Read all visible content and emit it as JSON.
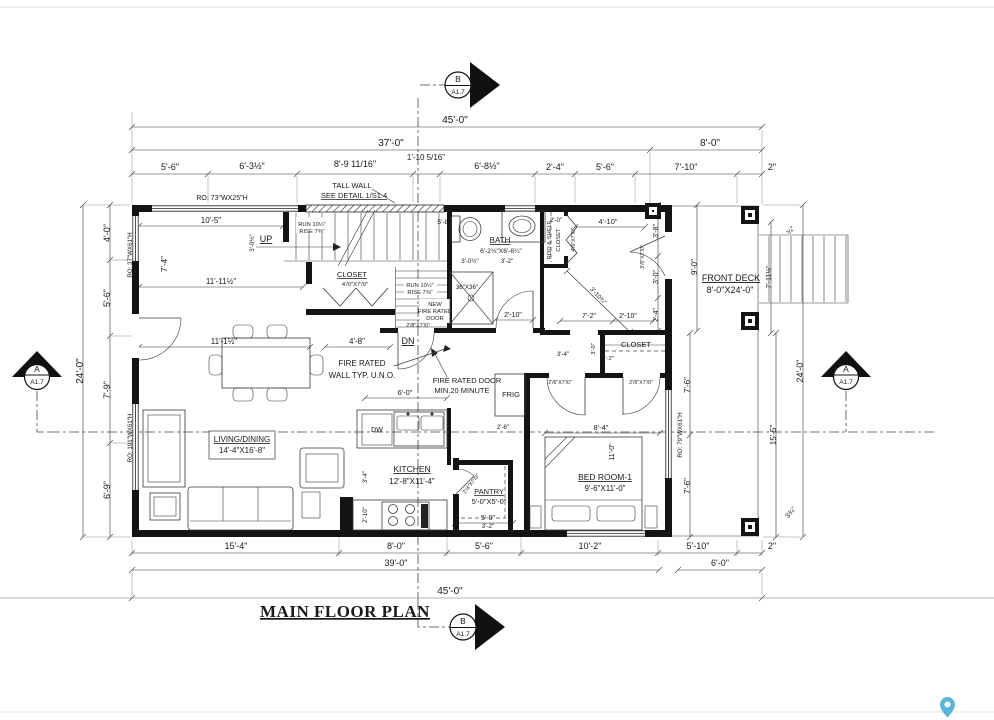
{
  "title": "MAIN FLOOR PLAN",
  "markers": {
    "top": {
      "letter": "B",
      "sheet": "A1.7"
    },
    "bottom": {
      "letter": "B",
      "sheet": "A1.7"
    },
    "left": {
      "letter": "A",
      "sheet": "A1.7"
    },
    "right": {
      "letter": "A",
      "sheet": "A1.7"
    }
  },
  "labels": {
    "dim_top_45": "45'-0\"",
    "dim_top_37": "37'-0\"",
    "dim_top_8": "8'-0\"",
    "dim_top_5_6": "5'-6\"",
    "dim_top_6_3": "6'-3½\"",
    "dim_top_8_9": "8'-9 11/16\"",
    "dim_top_1_10": "1'-10 5/16\"",
    "dim_top_6_8": "6'-8½\"",
    "dim_top_2_4": "2'-4\"",
    "dim_top_5_6b": "5'-6\"",
    "dim_top_7_10": "7'-10\"",
    "dim_top_2": "2\"",
    "dim_left_24": "24'-0\"",
    "dim_left_4_0": "4'-0\"",
    "dim_left_5_6": "5'-6\"",
    "dim_left_7_9": "7'-9\"",
    "dim_left_6_9": "6'-9\"",
    "dim_bot_15_4": "15'-4\"",
    "dim_bot_8_0": "8'-0\"",
    "dim_bot_5_6": "5'-6\"",
    "dim_bot_10_2": "10'-2\"",
    "dim_bot_5_10": "5'-10\"",
    "dim_bot_2": "2\"",
    "dim_bot_39": "39'-0\"",
    "dim_bot_6_0": "6'-0\"",
    "dim_bot_45": "45'-0\"",
    "dim_right_3_8": "3'-8\"",
    "dim_right_3_0": "3'-0\"",
    "dim_right_2_4": "2'-4\"",
    "dim_right_9_0": "9'-0\"",
    "dim_right_7_6a": "7'-6\"",
    "dim_right_7_6b": "7'-6\"",
    "dim_right_24": "24'-0\"",
    "dim_right_15_5": "15'-5\"",
    "dim_right_7_11": "7'-11½\"",
    "dim_right_034": "¾\"",
    "dim_right_334": "3¾\"",
    "ro_top": "RO: 73\"WX25\"H",
    "ro_left_upper": "RO: 37\"WX61\"H",
    "ro_left_lower": "RO: 191\"WX61\"H",
    "ro_right": "RO: 79\"WX61\"H",
    "tall_wall_1": "TALL WALL",
    "tall_wall_2": "SEE DETAIL 1/S1.4",
    "dim_10_5": "10'-5\"",
    "up": "UP",
    "run1": "RUN 10½\"",
    "rise1": "RISE 7⅜\"",
    "dim_11_11": "11'-11½\"",
    "dim_7_4": "7'-4\"",
    "dim_3_0h": "3'-0½\"",
    "stair_closet": "CLOSET",
    "stair_closet_door": "4'/0\"X7'/0\"",
    "dim_5_8": "5'-8\"",
    "run2": "RUN 10½\"",
    "rise2": "RISE 7⅜\"",
    "new_fr_1": "NEW",
    "new_fr_2": "FIRE RATED",
    "new_fr_3": "DOOR",
    "fr_door_size": "2'/8\"X7'/0\"",
    "dn": "DN",
    "dim_4_8": "4'-8\"",
    "dim_11_1": "11'-1½\"",
    "bath": "BATH",
    "bath_dims": "6'-2½\"X6'-6¼\"",
    "dim_3_0b": "3'-0½\"",
    "dim_3_2b": "3'-2\"",
    "shower": "36\"X36\"",
    "dim_2_10b": "2'-10\"",
    "dim_2_0": "2'-0\"",
    "rod_shelf": "ROD & SHELF",
    "entry_closet": "CLOSET",
    "entry_closet_door": "4'/0\"X7'/0\"",
    "dim_4_10": "4'-10\"",
    "dim_3_10": "3'-10¾\"",
    "dim_7_2": "7'-2\"",
    "dim_2_10e": "2'-10\"",
    "front_door_size": "3'/0\"X7'/0\"",
    "bed_closet": "CLOSET",
    "dim_3_4c": "3'-4\"",
    "dim_3_0c": "3'-0\"",
    "dim_1_2": "1'-2\"",
    "bed_door_size": "2'/6\"X7'/0\"",
    "closet_door_size": "2'/6\"X7'/0\"",
    "dim_8_4": "8'-4\"",
    "dim_11_0": "11'-0\"",
    "bedroom": "BED ROOM-1",
    "bedroom_dims": "9'-6\"X11'-0\"",
    "fire_wall_1": "FIRE RATED",
    "fire_wall_2": "WALL TYP. U.N.O.",
    "fire_door_1": "FIRE RATED DOOR",
    "fire_door_2": "MIN.20 MINUTE",
    "frig": "FRIG",
    "living": "LIVING/DINING",
    "living_dims": "14'-4\"X16'-8\"",
    "kitchen": "KITCHEN",
    "kitchen_dims": "12'-8\"X11'-4\"",
    "dw": "DW",
    "pantry": "PANTRY",
    "pantry_dims": "5'-0\"X5'-0\"",
    "dim_5_0": "5'-0\"",
    "dim_3_2p": "3'-2\"",
    "pantry_door_size": "2'/4\"X7'/0\"",
    "dim_3_4k": "3'-4\"",
    "dim_2_10k": "2'-10\"",
    "dim_6_0k": "6'-0\"",
    "dim_2_6": "2'-6\"",
    "front_deck": "FRONT DECK",
    "deck_dims": "8'-0\"X24'-0\""
  }
}
